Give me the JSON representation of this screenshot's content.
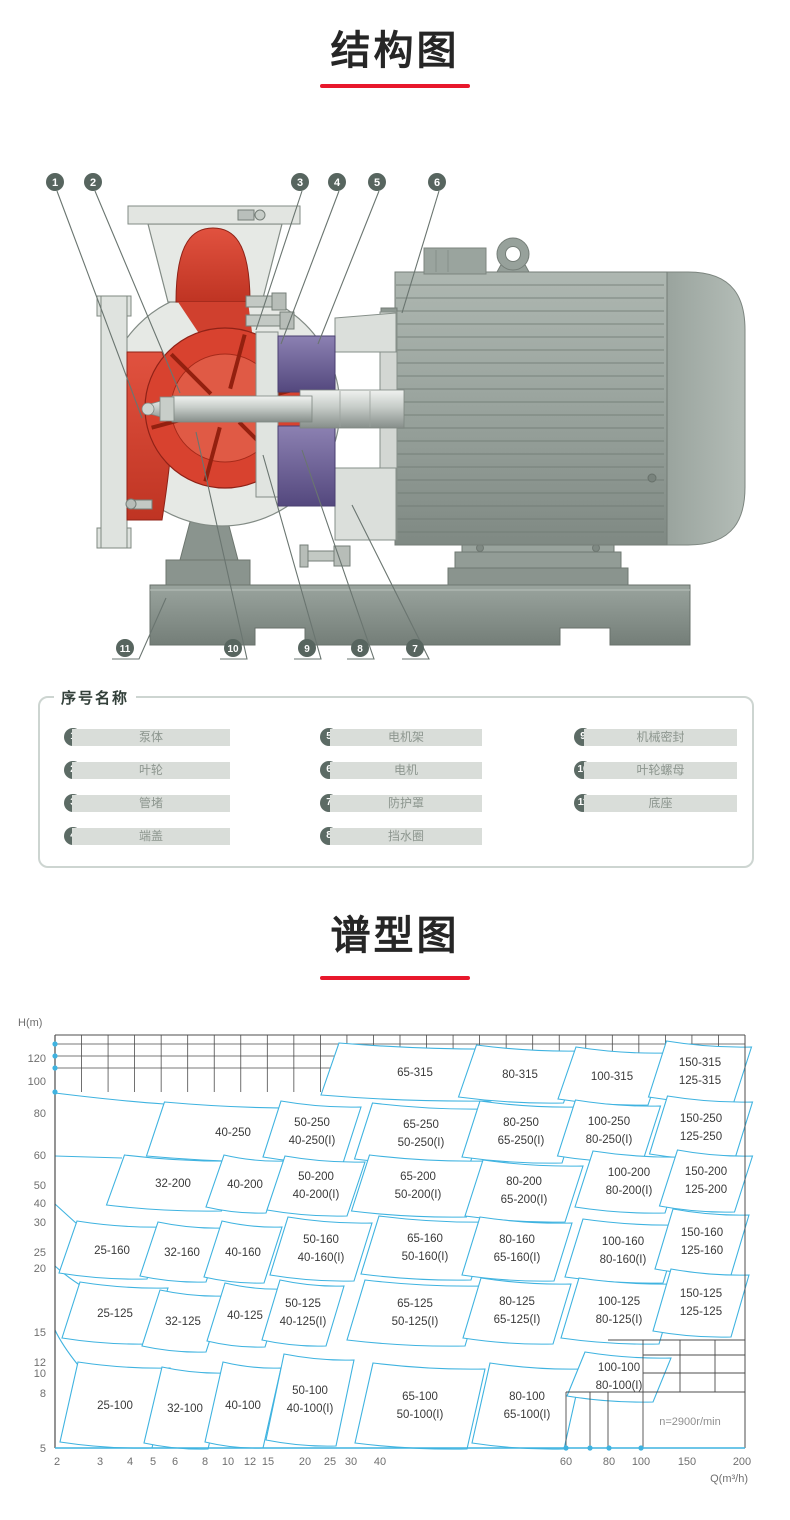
{
  "page": {
    "bg": "#ffffff",
    "accent_red": "#e8182c"
  },
  "sections": {
    "structure": {
      "title": "结构图"
    },
    "spectrum": {
      "title": "谱型图"
    }
  },
  "diagram": {
    "callouts_top": [
      "1",
      "2",
      "3",
      "4",
      "5",
      "6"
    ],
    "callouts_bottom": [
      "11",
      "10",
      "9",
      "8",
      "7"
    ]
  },
  "parts": {
    "legend": "序号名称",
    "columns": [
      [
        {
          "num": "1",
          "name": "泵体"
        },
        {
          "num": "2",
          "name": "叶轮"
        },
        {
          "num": "3",
          "name": "管堵"
        },
        {
          "num": "4",
          "name": "端盖"
        }
      ],
      [
        {
          "num": "5",
          "name": "电机架"
        },
        {
          "num": "6",
          "name": "电机"
        },
        {
          "num": "7",
          "name": "防护罩"
        },
        {
          "num": "8",
          "name": "挡水圈"
        }
      ],
      [
        {
          "num": "9",
          "name": "机械密封"
        },
        {
          "num": "10",
          "name": "叶轮螺母"
        },
        {
          "num": "11",
          "name": "底座"
        }
      ]
    ]
  },
  "chart_data": {
    "type": "pump_selection_chart",
    "title": "谱型图",
    "xlabel": "Q(m³/h)",
    "ylabel": "H(m)",
    "speed_note": "n=2900r/min",
    "x_ticks": [
      "2",
      "3",
      "4",
      "5",
      "6",
      "8",
      "10",
      "12",
      "15",
      "20",
      "25",
      "30",
      "40",
      "60",
      "80",
      "100",
      "150",
      "200"
    ],
    "y_ticks": [
      "120",
      "100",
      "80",
      "60",
      "50",
      "40",
      "30",
      "25",
      "20",
      "15",
      "12",
      "10",
      "8",
      "5"
    ],
    "x_range": [
      2,
      200
    ],
    "y_range": [
      5,
      130
    ],
    "grid": true,
    "curve_color": "#3fb3e0",
    "rows": [
      {
        "size": "315",
        "cells": [
          [
            "65-315"
          ],
          [
            "80-315"
          ],
          [
            "100-315"
          ],
          [
            "150-315",
            "125-315"
          ]
        ]
      },
      {
        "size": "250",
        "cells": [
          [
            "40-250"
          ],
          [
            "50-250",
            "40-250(I)"
          ],
          [
            "65-250",
            "50-250(I)"
          ],
          [
            "80-250",
            "65-250(I)"
          ],
          [
            "100-250",
            "80-250(I)"
          ],
          [
            "150-250",
            "125-250"
          ]
        ]
      },
      {
        "size": "200",
        "cells": [
          [
            "32-200"
          ],
          [
            "40-200"
          ],
          [
            "50-200",
            "40-200(I)"
          ],
          [
            "65-200",
            "50-200(I)"
          ],
          [
            "80-200",
            "65-200(I)"
          ],
          [
            "100-200",
            "80-200(I)"
          ],
          [
            "150-200",
            "125-200"
          ]
        ]
      },
      {
        "size": "160",
        "cells": [
          [
            "25-160"
          ],
          [
            "32-160"
          ],
          [
            "40-160"
          ],
          [
            "50-160",
            "40-160(I)"
          ],
          [
            "65-160",
            "50-160(I)"
          ],
          [
            "80-160",
            "65-160(I)"
          ],
          [
            "100-160",
            "80-160(I)"
          ],
          [
            "150-160",
            "125-160"
          ]
        ]
      },
      {
        "size": "125",
        "cells": [
          [
            "25-125"
          ],
          [
            "32-125"
          ],
          [
            "40-125"
          ],
          [
            "50-125",
            "40-125(I)"
          ],
          [
            "65-125",
            "50-125(I)"
          ],
          [
            "80-125",
            "65-125(I)"
          ],
          [
            "100-125",
            "80-125(I)"
          ],
          [
            "150-125",
            "125-125"
          ]
        ]
      },
      {
        "size": "100",
        "cells": [
          [
            "25-100"
          ],
          [
            "32-100"
          ],
          [
            "40-100"
          ],
          [
            "50-100",
            "40-100(I)"
          ],
          [
            "65-100",
            "50-100(I)"
          ],
          [
            "80-100",
            "65-100(I)"
          ],
          [
            "100-100",
            "80-100(I)"
          ]
        ]
      }
    ]
  }
}
